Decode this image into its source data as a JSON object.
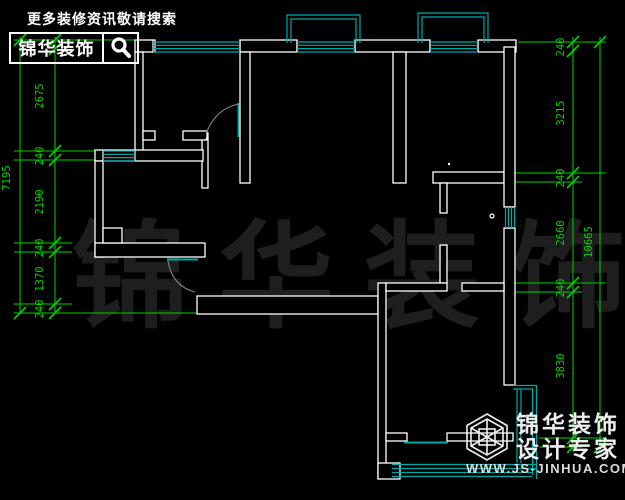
{
  "branding": {
    "top_tagline": "更多装修资讯敬请搜索",
    "top_logo_text": "锦华装饰",
    "bottom_logo_line1": "锦华装饰",
    "bottom_logo_line2": "设计专家",
    "bottom_logo_url": "WWW.JS-JINHUA.COM"
  },
  "watermark": {
    "text": "锦华装饰"
  },
  "dimensions": {
    "left": {
      "overall": "7195",
      "segments": [
        "2675",
        "240",
        "2190",
        "240",
        "1370",
        "240"
      ]
    },
    "right": {
      "overall": "10665",
      "segments": [
        "240",
        "3215",
        "240",
        "2660",
        "240",
        "3830"
      ]
    }
  },
  "colors": {
    "background": "#000000",
    "walls": "#ffffff",
    "windows": "#00a8a8",
    "dimensions": "#00d200",
    "watermark": "#1e1e1e",
    "door_arc": "#8a8a8a"
  }
}
